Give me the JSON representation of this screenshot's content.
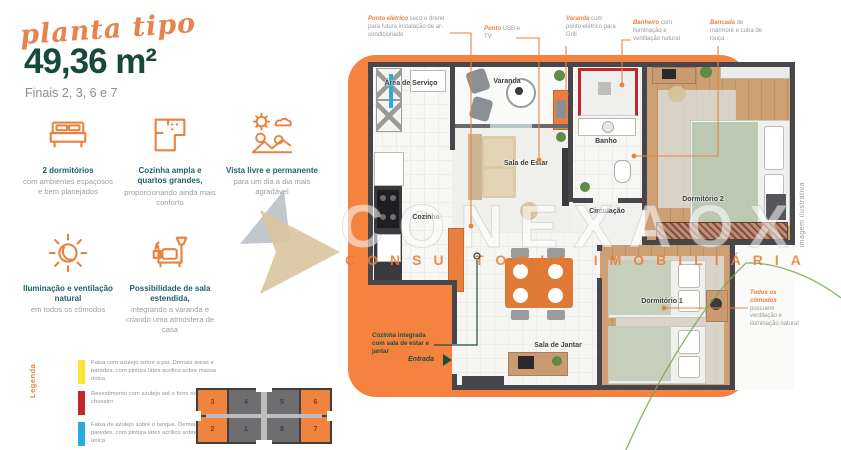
{
  "colors": {
    "accent_orange": "#E8823F",
    "panel_orange": "#F5823F",
    "dark_green": "#17493D",
    "teal_title": "#20606C",
    "legend_yellow": "#F7E733",
    "legend_red": "#C1272D",
    "legend_blue": "#29ABE2"
  },
  "header": {
    "script_title": "planta tipo",
    "area": "49,36 m²",
    "subtitle": "Finais 2, 3, 6 e 7"
  },
  "features": [
    {
      "icon": "bed-icon",
      "title": "2 dormitórios",
      "description": "com ambientes espaçosos e bem planejados"
    },
    {
      "icon": "floorplan-icon",
      "title": "Cozinha ampla e quartos grandes,",
      "description": "proporcionando ainda mais conforto"
    },
    {
      "icon": "view-landscape-icon",
      "title": "Vista livre e permanente",
      "description": "para um dia a dia mais agradável"
    },
    {
      "icon": "sun-icon",
      "title": "Iluminação e ventilação natural",
      "description": "em todos os cômodos"
    },
    {
      "icon": "armchair-lamp-icon",
      "title": "Possibilidade de sala estendida,",
      "description": "integrando a varanda e criando uma atmosfera de casa"
    }
  ],
  "legend": {
    "label": "Legenda",
    "items": [
      {
        "color": "#F7E733",
        "text": "Faixa com azulejo sobre a pia. Demais áreas e paredes, com pintura látex acrílico sobre massa única"
      },
      {
        "color": "#C1272D",
        "text": "Revestimento com azulejo até o forro no box do chuveiro"
      },
      {
        "color": "#29ABE2",
        "text": "Faixa de azulejo sobre o tanque. Demais áreas e paredes, com pintura látex acrílico sobre massa única"
      }
    ]
  },
  "keyplan": {
    "highlighted_units": [
      "2",
      "3",
      "6",
      "7"
    ],
    "units": [
      {
        "n": "3",
        "highlighted": true
      },
      {
        "n": "4",
        "highlighted": false
      },
      {
        "n": "5",
        "highlighted": false
      },
      {
        "n": "6",
        "highlighted": true
      },
      {
        "n": "2",
        "highlighted": true
      },
      {
        "n": "1",
        "highlighted": false
      },
      {
        "n": "8",
        "highlighted": false
      },
      {
        "n": "7",
        "highlighted": true
      }
    ]
  },
  "callouts": {
    "top": [
      {
        "bold": "Ponto elétrico",
        "rest": " seco e dreno para futura instalação de ar-condicionado"
      },
      {
        "bold": "Ponto",
        "rest": " USB e TV"
      },
      {
        "bold": "Varanda",
        "rest": " com ponto elétrico para Grill"
      },
      {
        "bold": "Banheiro",
        "rest": " com iluminação e ventilação natural"
      },
      {
        "bold": "Bancada",
        "rest": " de mármore e cuba de louça"
      }
    ],
    "right": {
      "bold": "Todos os cômodos",
      "rest": " possuem ventilação e iluminação natural"
    },
    "kitchen": {
      "bold": "Cozinha",
      "rest": " integrada com sala de estar e jantar"
    },
    "entrada": "Entrada"
  },
  "plan": {
    "rooms": {
      "area_servico": "Área de Serviço",
      "varanda": "Varanda",
      "sala_estar": "Sala de Estar",
      "banho": "Banho",
      "dormitorio2": "Dormitório 2",
      "circulacao": "Circulação",
      "cozinha": "Cozinha",
      "sala_jantar": "Sala de Jantar",
      "dormitorio1": "Dormitório 1"
    }
  },
  "watermark": {
    "brand": "CONEXAOX",
    "tagline": "CONSULTORIA IMOBILIÁRIA"
  },
  "disclaimer": "imagem ilustrativa"
}
